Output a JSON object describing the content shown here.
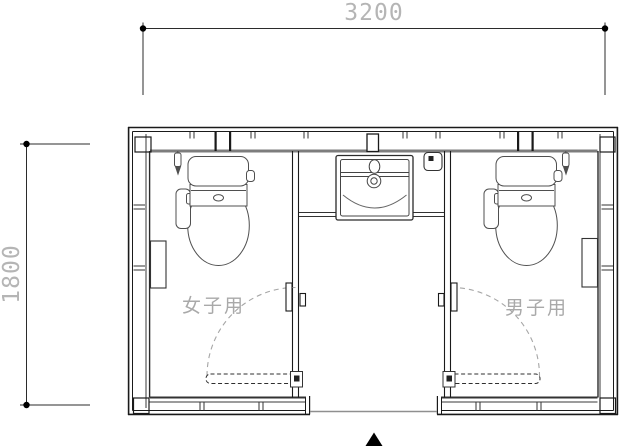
{
  "page": {
    "background": "#ffffff"
  },
  "plan": {
    "type": "restroom-floor-plan",
    "dimension_top": {
      "value": "3200"
    },
    "dimension_left": {
      "value": "1800"
    },
    "room_left": {
      "label": "女子用"
    },
    "room_right": {
      "label": "男子用"
    },
    "entrance_marker_icon": "▲",
    "colors": {
      "wall_line": "#1a1a1a",
      "wall_face_gray": "#7d7d7d",
      "threshold_gray": "#8f8f8f",
      "fixture_line": "#4f4f4f",
      "dimension_text": "#b5b5b5",
      "room_label_text": "#a9a9a9",
      "door_arc": "#a6a6a6",
      "background": "#ffffff"
    }
  }
}
